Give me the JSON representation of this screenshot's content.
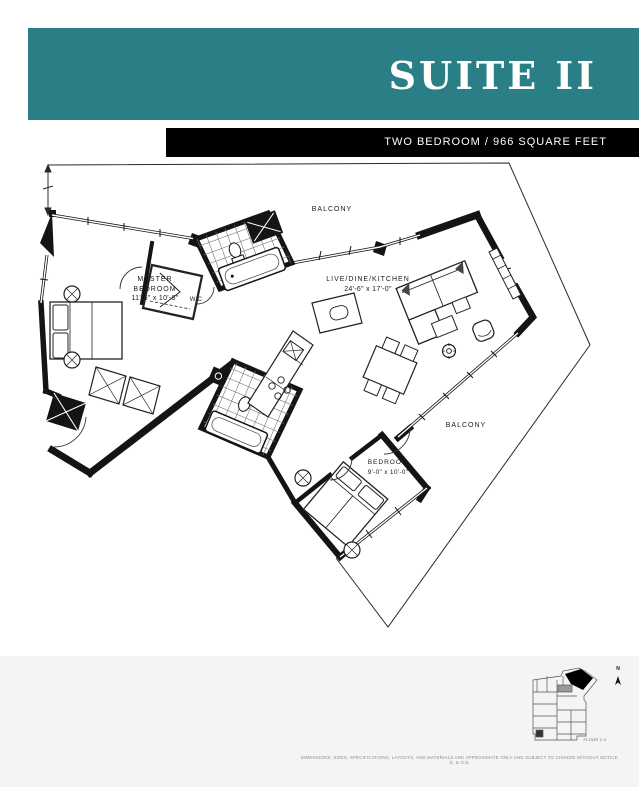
{
  "header": {
    "title": "SUITE II",
    "subtitle": "TWO BEDROOM / 966 SQUARE FEET"
  },
  "plan": {
    "balcony_top": "BALCONY",
    "balcony_right": "BALCONY",
    "master_bedroom": {
      "line1": "MASTER",
      "line2": "BEDROOM",
      "dims": "11'-6\" x 10'-8\""
    },
    "wc": "W/C",
    "live_dine_kitchen": {
      "name": "LIVE/DINE/KITCHEN",
      "dims": "24'-6\" x 17'-0\""
    },
    "bedroom": {
      "name": "BEDROOM",
      "dims": "9'-0\" x 10'-0\""
    }
  },
  "footer": {
    "disclaimer": "DIMENSIONS, SIZES, SPECIFICATIONS, LAYOUTS, AND MATERIALS ARE APPROXIMATE ONLY AND SUBJECT TO CHANGE WITHOUT NOTICE. E. & O.E.",
    "keyplan_caption": "FLOOR 2-4",
    "compass_label": "N"
  },
  "colors": {
    "accent_teal": "#2A7E85",
    "bar_black": "#000000",
    "line_black": "#141414",
    "footer_gray": "#f4f4f4"
  }
}
